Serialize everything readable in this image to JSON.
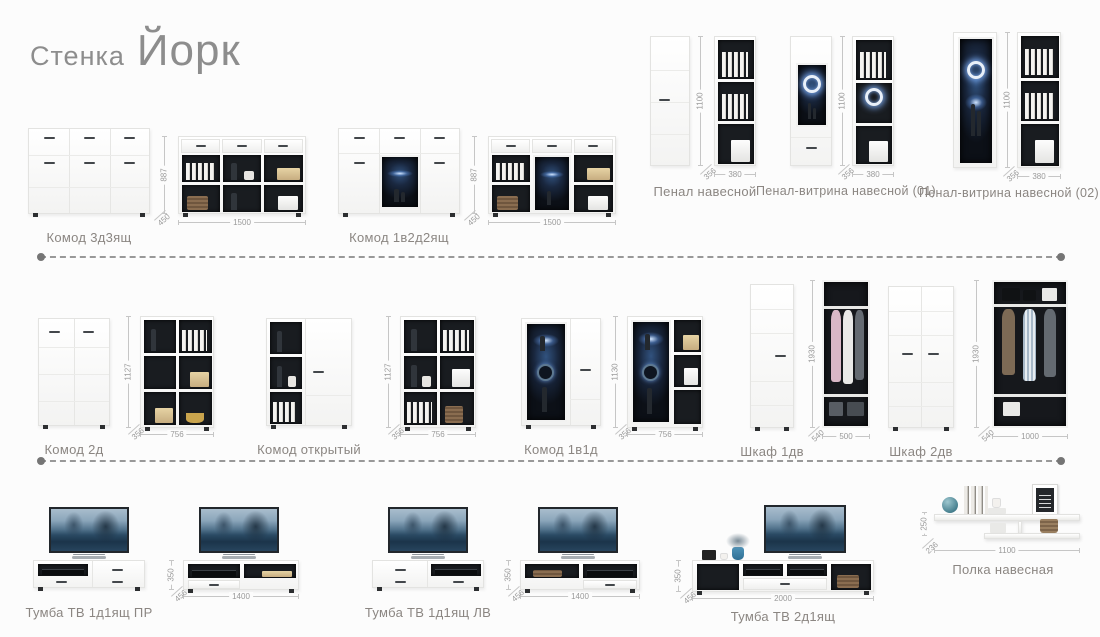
{
  "page": {
    "title_prefix": "Стенка",
    "title_main": "Йорк"
  },
  "colors": {
    "background": "#fcfcfc",
    "label_gray": "#8b8682",
    "dimension_gray": "#9a9a9a",
    "interior_dark": "#191c20",
    "led_glow_blue": "#6ea8ff",
    "separator_gray": "#989898"
  },
  "products": [
    {
      "id": "komod-3d3yashch",
      "name": "Комод 3д3ящ",
      "height": "887",
      "width": "1500",
      "depth": "450"
    },
    {
      "id": "komod-1v2d2yashch",
      "name": "Комод 1в2д2ящ",
      "height": "887",
      "width": "1500",
      "depth": "450"
    },
    {
      "id": "penal-navesnoy",
      "name": "Пенал навесной",
      "height": "1100",
      "width": "380",
      "depth": "356"
    },
    {
      "id": "penal-vitrina-01",
      "name": "Пенал-витрина навесной (01)",
      "height": "1100",
      "width": "380",
      "depth": "356"
    },
    {
      "id": "penal-vitrina-02",
      "name": "Пенал-витрина навесной (02)",
      "height": "1100",
      "width": "380",
      "depth": "356"
    },
    {
      "id": "komod-2d",
      "name": "Комод 2д",
      "height": "1127",
      "width": "756",
      "depth": "356"
    },
    {
      "id": "komod-otkrytyy",
      "name": "Комод открытый",
      "height": "1127",
      "width": "756",
      "depth": "356"
    },
    {
      "id": "komod-1v1d",
      "name": "Комод 1в1д",
      "height": "1130",
      "width": "756",
      "depth": "356"
    },
    {
      "id": "shkaf-1dv",
      "name": "Шкаф 1дв",
      "height": "1930",
      "width": "500",
      "depth": "540"
    },
    {
      "id": "shkaf-2dv",
      "name": "Шкаф 2дв",
      "height": "1930",
      "width": "1000",
      "depth": "540"
    },
    {
      "id": "tumba-tv-1d1yashch-pr",
      "name": "Тумба ТВ 1д1ящ ПР",
      "height": "350",
      "width": "1400",
      "depth": "456"
    },
    {
      "id": "tumba-tv-1d1yashch-lv",
      "name": "Тумба ТВ 1д1ящ ЛВ",
      "height": "350",
      "width": "1400",
      "depth": "456"
    },
    {
      "id": "tumba-tv-2d1yashch",
      "name": "Тумба ТВ 2д1ящ",
      "height": "350",
      "width": "2000",
      "depth": "456"
    },
    {
      "id": "polka-navesnaya",
      "name": "Полка навесная",
      "height": "250",
      "width": "1100",
      "depth": "236"
    }
  ]
}
